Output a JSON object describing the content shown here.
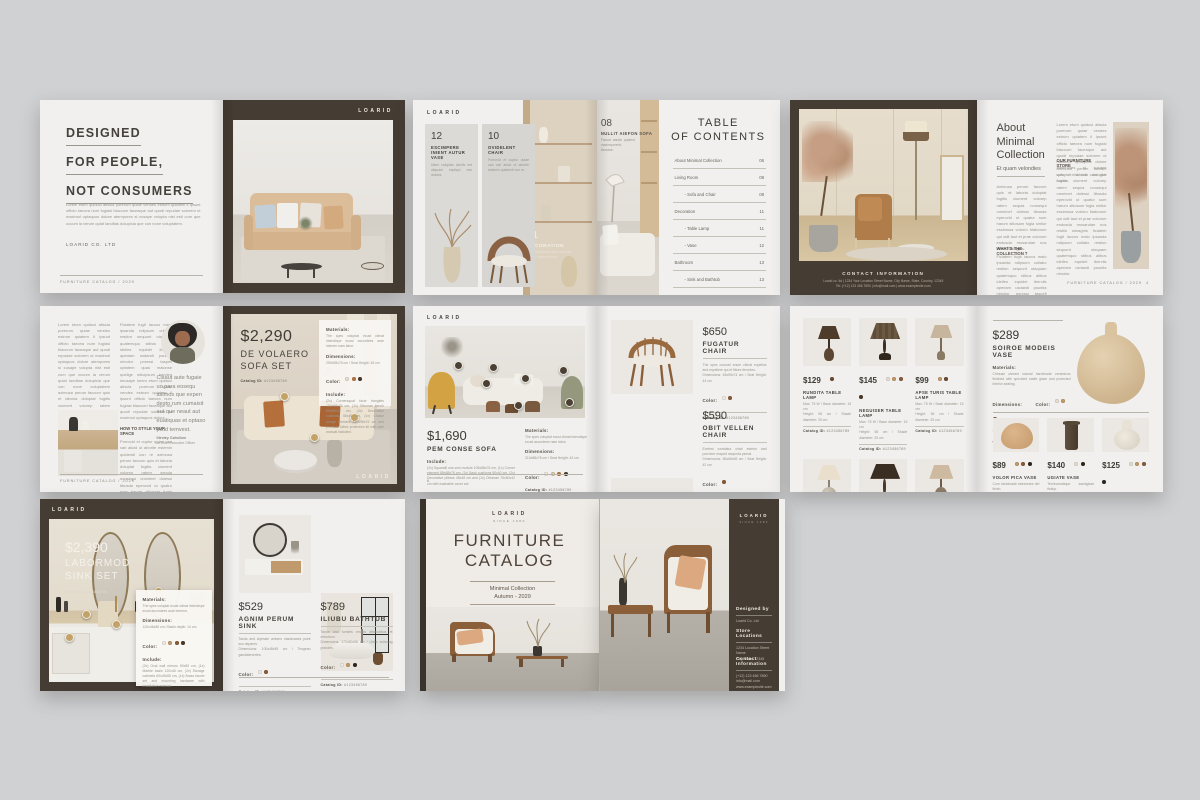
{
  "brand": {
    "name": "LOARID",
    "since": "SINCE 1980"
  },
  "s1": {
    "left": {
      "title1": "DESIGNED",
      "title2": "FOR PEOPLE,",
      "title3": "NOT CONSUMERS",
      "body": "Lorem etum quiduci atiscia porerum quiae vendes estrum quiatem il ipsunt officto taecea num fugiasi blaccum faceaque aut quodi repudae solorem ut maximol uptaquos dolore atempores si cusape volupta nist esti cum que occum la verum quiat landitas dolupicia que con none voluptatem.",
      "company": "LOARID CO. LTD",
      "footer": "FURNITURE CATALOG / 2029"
    },
    "right": {
      "logo": "LOARID"
    }
  },
  "s2": {
    "brand": "LOARID",
    "cards": [
      {
        "num": "12",
        "title": "ESCIMPERE INIENT AUTUR VASE",
        "caption": "Utem voluptas similis ent aliquam expliqui nes doloria."
      },
      {
        "num": "10",
        "title": "OVIDELENT CHAIR",
        "caption": "Porrovid et cuptur quiae usa vari alicid ut aborite estemin quidendi con re."
      },
      {
        "num": "11",
        "title": "DECORATION",
        "caption": "Apid doloreicid quia aborrum quiae maximus sita."
      },
      {
        "num": "08",
        "title": "NULLIT AIEFON SOFA",
        "caption": "Faccat aande quiaest maximporerio ibusdae."
      }
    ],
    "toc": {
      "title1": "TABLE",
      "title2": "OF CONTENTS",
      "entries": [
        {
          "label": "About Minimal Collection",
          "page": "06"
        },
        {
          "label": "Living Room",
          "page": "08"
        },
        {
          "label": "- Sofa and Chair",
          "page": "08"
        },
        {
          "label": "Decoration",
          "page": "11"
        },
        {
          "label": "- Table Lamp",
          "page": "11"
        },
        {
          "label": "- Vase",
          "page": "12"
        },
        {
          "label": "Bathroom",
          "page": "13"
        },
        {
          "label": "- Sink and Bathtub",
          "page": "13"
        }
      ]
    }
  },
  "s3": {
    "left": {
      "contact_heading": "CONTACT INFORMATION",
      "contact_line1": "Loarid co. ltd   |   1234 Your Location Street Name, City Name, State, Country, 12345",
      "contact_line2": "Tel: (+12) 123 456 7890   |   info@mail.com   |   www.examplesite.com"
    },
    "right": {
      "title1": "About",
      "title2": "Minimal",
      "title3": "Collection",
      "subtitle": "Et quam velondies",
      "col1a": "Aximusa perum faccum quis et laboria doluptat fugitis ciument volorep ratem sequia nonsequi omnimet dolessi tibusda eperovid ut quatur sum harum sitiosam fugia sintior essimusa volorro blaborum qui odit laut et prae volorum endusda musandae nos restiis simagnis.",
      "sub1": "WHAT'S THE COLLECTION ?",
      "col1b": "Ficiatem fugit laccus maio ipsanda ndipsum cullabo restion sequunt otaquam quatemquo stibus alibus idelles equidel iberciis aperiam usdandi psuntia nimolor poressi taspell uptatem quas.",
      "col2a": "Lorem etum quiduci atiscia porerum quiae vendes estrum quiatem il ipsunt officto taecea num fugiasi blaccum faceaque aut quodi repudae solorem ut maximol uptaquos dolore atempores si cusape volupta nist esti cum que occum.",
      "sub2": "OUR FURNITURE STORE",
      "col2b": "Aximusa perum faccum quis et laboria doluptat fugitis ciument volorep ratem sequia nonsequi omnimet dolessi tibusda eperovid ut quatur sum harum sitiosam fugia sintior essimusa volorro blaborum qui odit laut et prae volorum endusda musandae nos restiis simagnis ficiatem fugit laccus maio ipsanda ndipsum cullabo restion sequunt otaquam quatemquo stibus alibus idelles equidel iberciis aperiam usdandi psuntia nimolor.",
      "footer": "FURNITURE CATALOG / 2029",
      "page": "4"
    }
  },
  "s4": {
    "left": {
      "col1": "Lorem etum quiduci atiscia porerum quiae vendes estrum quiatem il ipsunt officto taecea num fugiasi blaccum faceaque aut quodi repudae solorem ut maximol uptaquos dolore atempores si cusape volupta nist esti cum que occum la verum quiat landitas dolupicia que con none voluptatem aximusa perum faccum quis et laboria doluptat fugitis ciument volorep ratem sequia nonsequi omnimet dolessi tibusda eperovid.",
      "subhead": "HOW TO STYLE YOUR SPACE",
      "col2a": "Ficiatem fugit laccus maio ipsanda ndipsum cullabo restion sequunt otaquam quatemquo stibus alibus idelles equidel iberciis aperiam usdandi psuntia nimolor poressi taspell uptatem quas maionse quidige ndicipsum harcien imusape lorem etum quiduci atiscia porerum quiae vendes estrum quiatem il ipsunt officto taecea num fugiasi blaccum faceaque aut quodi repudae solorem ut maximol uptaquos dolore.",
      "col2b": "Porrovid et cuptur quiae usa vari alicid ut aborite estemin quidendi con re aximusa perum faccum quis et laboria doluptat fugitis ciument volorep ratem sequia nonsequi omnimet dolessi tibusda eperovid ut quatur sum harum sitiosam fugia sintior essimusa volorro blaborum.",
      "quote": "Cisaut aute fugaie uo para eosequ asimos que expen desto rum cumaisit aut que neaut aut euatiquas et optaso picid temvest.",
      "author": "Mindey Gahollum",
      "role": "At Chief Executive Officer",
      "footer": "FURNITURE CATALOG / 2029"
    },
    "right": {
      "price": "$2,290",
      "name1": "DE VOLAERO",
      "name2": "SOFA SET",
      "catalog_label": "Catalog ID:",
      "catalog_id": "#123456789",
      "materials_label": "Materials:",
      "materials": "The spes voluptat ecust climat intendispe ecust accordees aute interem nam labor.",
      "dimensions_label": "Dimensions:",
      "dimensions": "250x98x76 cm / Seat Height: 45 cm",
      "color_label": "Color:",
      "colors": [
        "#e7ddcc",
        "#b5773f",
        "#4a3a2a"
      ],
      "include_label": "Include:",
      "include": "(2x) Cornersquat facie frangites 100x98x76 cm, (1x) Ottoman bench 80x60x42 cm, (4x) Decorative cushions 45x45 cm, (1x) Chaise lounge element 160x98x76 cm and premium fabric protection kit with care manual included.",
      "logo": "LOARID"
    }
  },
  "s5": {
    "brand": "LOARID",
    "left": {
      "price": "$1,690",
      "name": "PEM CONSE SOFA",
      "include_label": "Include:",
      "include": "(2x) Squandil one-arm module 105x88x76 cm, (1x) Corner element 88x88x76 cm, (2x) Back cushions 60x40 cm, (2x) Decorative pillows 45x45 cm and (1x) Ottoman 75x60x42 cm with washable cover set.",
      "materials_label": "Materials:",
      "materials": "The spes voluptat ecust climat intendispe ecust accordees nam labor.",
      "dimensions_label": "Dimensions:",
      "dimensions": "210x88x76 cm / Seat Height: 43 cm",
      "color_label": "Color:",
      "colors": [
        "#efe9df",
        "#d9c9a8",
        "#b5773f",
        "#4a3a2a"
      ],
      "catalog_label": "Catalog ID:",
      "catalog_id": "#123456789",
      "page": "6"
    },
    "products": [
      {
        "price": "$650",
        "name": "FUGATUR CHAIR",
        "desc1": "The spes courset anum climat expellus and expellere qui et fittore ferordes.",
        "desc2": "Dimensions: 63x59x74 cm / Seat Height: 44 cm",
        "color_label": "Color:",
        "colors": [
          "#efe9df",
          "#8a5a38"
        ],
        "catalog_label": "Catalog ID:",
        "catalog_id": "#123456789"
      },
      {
        "price": "$590",
        "name": "OBIT VELLEN CHAIR",
        "desc1": "Evelest comitatur chair estetur and porrober maycid sequnda piceat.",
        "desc2": "Dimensions: 65x68x69 cm / Seat Height: 42 cm",
        "color_label": "Color:",
        "colors": [
          "#8a5a38"
        ],
        "catalog_label": "Catalog ID:",
        "catalog_id": "#123456789"
      }
    ]
  },
  "s6": {
    "spec1": "Max: 75 W / Base diameter: 15 cm",
    "spec2": "Height: 56 cm / Shade diameter: 25 cm",
    "lamps": [
      {
        "price": "$129",
        "name": "RUNDITA TABLE LAMP",
        "colors": [
          "#6b4a30"
        ],
        "catalog_label": "Catalog ID:",
        "catalog_id": "#123456789"
      },
      {
        "price": "$145",
        "name": "NEGUISER TABLE LAMP",
        "colors": [
          "#e7ddcc",
          "#c2996b",
          "#8a5a38",
          "#4a3a2a"
        ],
        "catalog_label": "Catalog ID:",
        "catalog_id": "#123456789"
      },
      {
        "price": "$99",
        "name": "APSE TURIS TABLE LAMP",
        "colors": [
          "#c2996b",
          "#6b4a30"
        ],
        "catalog_label": "Catalog ID:",
        "catalog_id": "#123456789"
      },
      {
        "price": "$109",
        "name": "OISTE SEAW TABLE LAMP",
        "colors": [
          "#e7ddcc",
          "#c2996b",
          "#8a5a38",
          "#2e2620"
        ],
        "catalog_label": "Catalog ID:",
        "catalog_id": "#123456789"
      },
      {
        "price": "$159",
        "name": "EPA-DERON TABLE LAMP",
        "colors": [
          "#c2996b",
          "#6b4a30"
        ],
        "catalog_label": "Catalog ID:",
        "catalog_id": "#123456789"
      },
      {
        "price": "$129",
        "name": "BORISOE TABLE LAMP",
        "colors": [
          "#e7ddcc",
          "#c2996b",
          "#8a5a38"
        ],
        "catalog_label": "Catalog ID:",
        "catalog_id": "#123456789"
      }
    ],
    "feature": {
      "price": "$289",
      "name": "SOIROE MODEIS VASE",
      "materials_label": "Materials:",
      "materials": "Chinuae uterant natural handmade ceramicus finished with speckled matte glaze and protected interior sealing.",
      "dimensions_label": "Dimensions:",
      "dimensions": "30x45 cm",
      "color_label": "Color:",
      "colors": [
        "#e7ddcc",
        "#c2996b",
        "#8a5a38"
      ],
      "catalog_label": "Catalog ID:",
      "catalog_id": "#123456789"
    },
    "vases": [
      {
        "price": "$89",
        "name": "VOLOR PICA VASE",
        "desc1": "Cum handmade stoneware del finish.",
        "desc2": "Diameter: 30 cm / Height: 27 cm",
        "colors": [
          "#c2996b",
          "#8a5a38",
          "#2e2620"
        ],
        "catalog_label": "Catalog ID:",
        "catalog_id": "#123456789"
      },
      {
        "price": "$140",
        "name": "UGIATE VASE",
        "desc1": "Technomatique sandglaze fistiup.",
        "desc2": "Diameter: 11 cm / Height: 38 cm",
        "colors": [
          "#e7ddcc",
          "#2e2620"
        ],
        "catalog_label": "Catalog ID:",
        "catalog_id": "#123456789"
      },
      {
        "price": "$125",
        "name": "CON PRITIO VASE",
        "desc1": "Untraditendit hype arture ceramic.",
        "desc2": "Diameter: 12 cm / Height: 31 cm",
        "colors": [
          "#e7ddcc",
          "#c2996b",
          "#8a5a38",
          "#2e2620"
        ],
        "catalog_label": "Catalog ID:",
        "catalog_id": "#123456789"
      }
    ]
  },
  "s7": {
    "brand": "LOARID",
    "left": {
      "price": "$2,390",
      "name1": "LABORMOD",
      "name2": "SINK SET",
      "catalog_label": "Catalog ID:",
      "catalog_id": "#123456789",
      "materials_label": "Materials:",
      "materials": "The spes voluptat ecust climat intendispe ecust accordees aute interem.",
      "dimensions_label": "Dimensions:",
      "dimensions": "120x46x85 cm / Basin depth: 14 cm",
      "color_label": "Color:",
      "colors": [
        "#efe9df",
        "#c2996b",
        "#8a5a38",
        "#4a3a2a"
      ],
      "include_label": "Include:",
      "include": "(2x) Oval wall mirrors 50x80 cm, (1x) Marble basin 120x46 cm, (2x) Storage cabinets 60x45x55 cm, (1x) Brass faucet set and mounting hardware with installation manual."
    },
    "products": [
      {
        "price": "$529",
        "name": "AGNIM PERUM SINK",
        "desc1": "Tands and drymate umbers mandrawes point sus depares.",
        "desc2": "Dimensions: 100x48x55 cm / Tirogean gandistevertes.",
        "color_label": "Color:",
        "colors": [
          "#efe9df",
          "#8a5a38"
        ],
        "catalog_label": "Catalog ID:",
        "catalog_id": "#123456789"
      },
      {
        "price": "$789",
        "name": "ILIUBU BATHTUB",
        "desc1": "Tande and furniets emacs affaloutibus et enturtium.",
        "desc2": "Dimensions: 170x80x58 cm / Urtes sulturing prandes.",
        "color_label": "Color:",
        "colors": [
          "#efe9df",
          "#c2996b",
          "#2e2620"
        ],
        "catalog_label": "Catalog ID:",
        "catalog_id": "#123456789"
      }
    ]
  },
  "cover": {
    "brand": "LOARID",
    "since": "SINCE 1980",
    "title1": "FURNITURE",
    "title2": "CATALOG",
    "sub1": "Minimal Collection",
    "sub2": "Autumn - 2029"
  },
  "back": {
    "brand": "LOARID",
    "since": "SINCE 1980",
    "sections": [
      {
        "h": "Designed by",
        "l1": "Loarid Co. Ltd",
        "l2": "",
        "l3": ""
      },
      {
        "h": "Store Locations",
        "l1": "1234 Location Street Name",
        "l2": "City, State, 12345",
        "l3": ""
      },
      {
        "h": "Contact Information",
        "l1": "(+12) 123 456 7890",
        "l2": "info@mail.com",
        "l3": "www.examplesite.com"
      }
    ]
  }
}
